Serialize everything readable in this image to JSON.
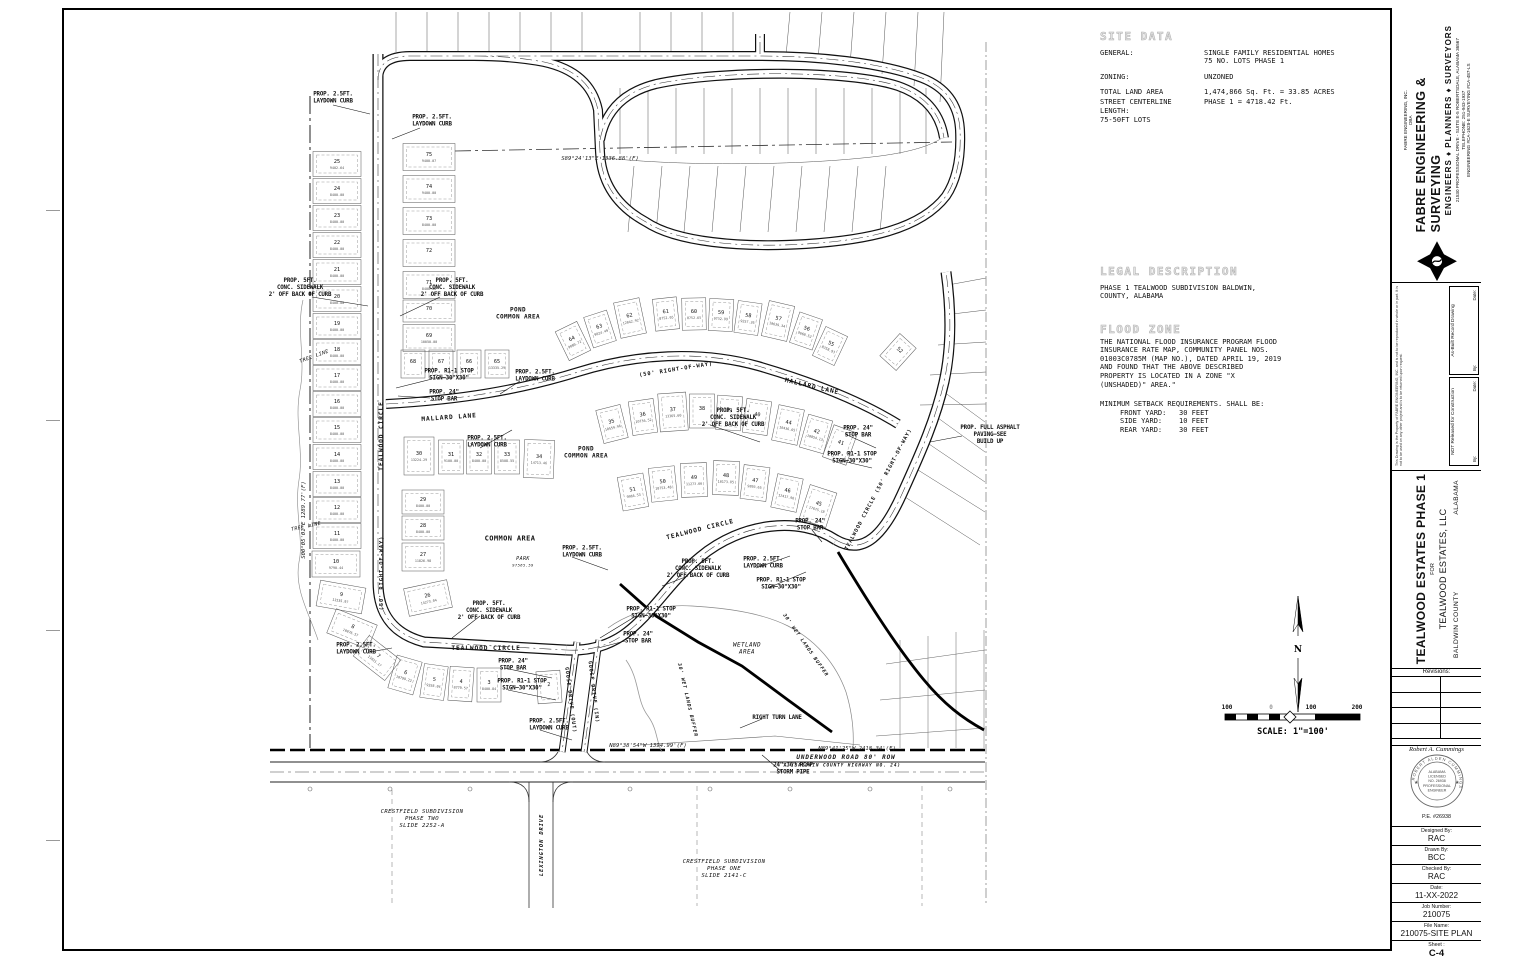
{
  "titleblock": {
    "firm": {
      "company_small": "FABRE ENGINEERING, INC.",
      "dba": "DBA",
      "name": "FABRE ENGINEERING & SURVEYING",
      "tagline": "ENGINEERS ♦ PLANNERS ♦ SURVEYORS",
      "address": "21530 PROFESSIONAL DRIVE - SUITE E-5   ROBERTSDALE, ALABAMA 36567",
      "phone": "TELEPHONE: 251-943-1937",
      "licenses": "ENGINEERING #CA-1628-E      SURVEYING #CA-487-LS"
    },
    "release": {
      "disclaimer": "This Drawing is the Property of FABRE ENGINEERING, INC. and is not to be reproduced in whole or in part. It is not to be used on any other project and is to be returned upon request.",
      "not_released": "NOT Released for Construction",
      "as_built": "As-Built Record Drawing",
      "by": "By:",
      "date": "Date:"
    },
    "project": {
      "title": "TEALWOOD ESTATES PHASE 1",
      "for_label": "FOR",
      "client": "TEALWOOD ESTATES, LLC",
      "county": "BALDWIN COUNTY",
      "state": "ALABAMA"
    },
    "revisions_label": "Revisions:",
    "seal": {
      "engineer": "Robert A. Cummings",
      "pe": "P.E. #26938",
      "ring_name": "ROBERT ALDEN CUMMINGS",
      "lines": [
        "ALABAMA",
        "LICENSED",
        "NO. 26938",
        "PROFESSIONAL",
        "ENGINEER"
      ]
    },
    "fields": [
      {
        "label": "Designed By:",
        "value": "RAC"
      },
      {
        "label": "Drawn By:",
        "value": "BCC"
      },
      {
        "label": "Checked By:",
        "value": "RAC"
      },
      {
        "label": "Date:",
        "value": "11-XX-2022"
      },
      {
        "label": "Job Number:",
        "value": "210075"
      },
      {
        "label": "File Name:",
        "value": "210075-SITE PLAN"
      },
      {
        "label": "Sheet :",
        "value": "C-4"
      }
    ]
  },
  "notes": {
    "site_data": {
      "title": "SITE DATA",
      "rows": [
        {
          "l": "GENERAL:",
          "v": "SINGLE FAMILY RESIDENTIAL HOMES\n75 NO. LOTS PHASE 1"
        },
        {
          "l": "ZONING:",
          "v": "UNZONED"
        },
        {
          "l": "TOTAL LAND AREA",
          "v": "1,474,866 Sq. Ft. =  33.85 ACRES"
        },
        {
          "l": "STREET CENTERLINE LENGTH:",
          "v": "PHASE 1 = 4718.42 Ft."
        },
        {
          "l": "75-50FT LOTS",
          "v": ""
        }
      ]
    },
    "legal": {
      "title": "LEGAL DESCRIPTION",
      "body": "PHASE 1 TEALWOOD SUBDIVISION BALDWIN,\nCOUNTY, ALABAMA"
    },
    "flood": {
      "title": "FLOOD ZONE",
      "body": "THE NATIONAL FLOOD INSURANCE PROGRAM FLOOD\nINSURANCE RATE MAP, COMMUNITY PANEL NOS.\n01003C0785M (MAP NO.), DATED APRIL 19, 2019\nAND FOUND THAT THE ABOVE DESCRIBED\nPROPERTY IS LOCATED IN A ZONE \"X\n(UNSHADED)\" AREA.\""
    },
    "setbacks": {
      "heading": "MINIMUM SETBACK REQUIREMENTS. SHALL BE:",
      "rows": "FRONT YARD:   30 FEET\nSIDE YARD:    10 FEET\nREAR YARD:    30 FEET"
    }
  },
  "plan": {
    "north_label": "N",
    "scalebar": {
      "labels": [
        "100",
        "0",
        "100",
        "200"
      ],
      "text": "SCALE: 1\"=100'"
    },
    "streets": [
      {
        "t": "TEALWOOD CIRCLE",
        "x": 381,
        "y": 436,
        "r": -90
      },
      {
        "t": "(50' RIGHT-OF-WAY)",
        "x": 381,
        "y": 573,
        "r": -90,
        "s": 5.4
      },
      {
        "t": "MALLARD LANE",
        "x": 449,
        "y": 417,
        "r": -4
      },
      {
        "t": "(50' RIGHT-OF-WAY)",
        "x": 676,
        "y": 369,
        "r": -9,
        "s": 5.4
      },
      {
        "t": "MALLARD LANE",
        "x": 812,
        "y": 386,
        "r": 13
      },
      {
        "t": "TEALWOOD CIRCLE",
        "x": 486,
        "y": 648,
        "r": 0
      },
      {
        "t": "TEALWOOD CIRCLE",
        "x": 700,
        "y": 529,
        "r": -14
      },
      {
        "t": "TEALWOOD CIRCLE (50' RIGHT-OF-WAY)",
        "x": 878,
        "y": 489,
        "r": -62,
        "s": 5.2
      },
      {
        "t": "GOOSE DRIVE (OUT)",
        "x": 571,
        "y": 700,
        "r": 83,
        "s": 5
      },
      {
        "t": "GOOSE DRIVE (IN)",
        "x": 594,
        "y": 692,
        "r": 83,
        "s": 5
      },
      {
        "t": "LEXINGTON DRIVE",
        "x": 541,
        "y": 845,
        "r": -90,
        "s": 5.4,
        "i": 1
      },
      {
        "t": "UNDERWOOD ROAD 80' ROW",
        "x": 846,
        "y": 757,
        "i": 1,
        "s": 6
      },
      {
        "t": "(BALDWIN COUNTY HIGHWAY NO. 24)",
        "x": 846,
        "y": 765,
        "i": 1,
        "s": 4.4
      },
      {
        "t": "30' WET LANDS BUFFER",
        "x": 688,
        "y": 700,
        "r": 77,
        "s": 4.8,
        "i": 1
      },
      {
        "t": "30' WET LANDS BUFFER",
        "x": 806,
        "y": 645,
        "r": 55,
        "s": 4.8,
        "i": 1
      }
    ],
    "callouts": [
      {
        "t": "PROP. 2.5FT.\nLAYDOWN CURB",
        "x": 333,
        "y": 97
      },
      {
        "t": "PROP. 2.5FT.\nLAYDOWN CURB",
        "x": 432,
        "y": 120
      },
      {
        "t": "PROP. 5FT.\nCONC. SIDEWALK\n2' OFF BACK OF CURB",
        "x": 300,
        "y": 287
      },
      {
        "t": "PROP. 5FT.\nCONC. SIDEWALK\n2' OFF BACK OF CURB",
        "x": 452,
        "y": 287
      },
      {
        "t": "PROP. R1-1 STOP\nSIGN—30\"X30\"",
        "x": 449,
        "y": 374
      },
      {
        "t": "PROP. 24\"\nSTOP BAR",
        "x": 444,
        "y": 395
      },
      {
        "t": "PROP. 2.5FT.\nLAYDOWN CURB",
        "x": 535,
        "y": 375
      },
      {
        "t": "PROP. 2.5FT.\nLAYDOWN CURB",
        "x": 487,
        "y": 441
      },
      {
        "t": "PROP. 5FT.\nCONC. SIDEWALK\n2' OFF BACK OF CURB",
        "x": 733,
        "y": 417
      },
      {
        "t": "PROP. 24\"\nSTOP BAR",
        "x": 858,
        "y": 431
      },
      {
        "t": "PROP. R1-1 STOP\nSIGN—30\"X30\"",
        "x": 852,
        "y": 457
      },
      {
        "t": "PROP. FULL ASPHALT\nPAVING—SEE\nBUILD UP",
        "x": 990,
        "y": 434
      },
      {
        "t": "PROP. 2.5FT.\nLAYDOWN CURB",
        "x": 582,
        "y": 551
      },
      {
        "t": "PROP. 5FT.\nCONC. SIDEWALK\n2' OFF BACK OF CURB",
        "x": 698,
        "y": 568
      },
      {
        "t": "PROP. 2.5FT.\nLAYDOWN CURB",
        "x": 763,
        "y": 562
      },
      {
        "t": "PROP. R1-1 STOP\nSIGN—30\"X30\"",
        "x": 781,
        "y": 583
      },
      {
        "t": "PROP. 24\"\nSTOP BAR",
        "x": 810,
        "y": 524
      },
      {
        "t": "PROP. R1-1 STOP\nSIGN—30\"X30\"",
        "x": 651,
        "y": 612
      },
      {
        "t": "PROP. 24\"\nSTOP BAR",
        "x": 638,
        "y": 637
      },
      {
        "t": "PROP. 2.5FT.\nLAYDOWN CURB",
        "x": 356,
        "y": 648
      },
      {
        "t": "PROP. 5FT.\nCONC. SIDEWALK\n2' OFF BACK OF CURB",
        "x": 489,
        "y": 610
      },
      {
        "t": "PROP. R1-1 STOP\nSIGN—30\"X30\"",
        "x": 522,
        "y": 684
      },
      {
        "t": "PROP. 24\"\nSTOP BAR",
        "x": 513,
        "y": 664
      },
      {
        "t": "PROP. 2.5FT.\nLAYDOWN CURB",
        "x": 549,
        "y": 724
      },
      {
        "t": "RIGHT TURN LANE",
        "x": 777,
        "y": 717
      },
      {
        "t": "24\"x36\" RCAP\nSTORM PIPE",
        "x": 793,
        "y": 768
      }
    ],
    "areas": [
      {
        "t": "POND\nCOMMON AREA",
        "x": 518,
        "y": 313
      },
      {
        "t": "POND\nCOMMON AREA",
        "x": 586,
        "y": 452
      },
      {
        "t": "COMMON AREA",
        "x": 510,
        "y": 538,
        "s": 7
      },
      {
        "t": "PARK",
        "x": 523,
        "y": 558,
        "s": 5,
        "i": 1
      },
      {
        "t": "97565.59",
        "x": 523,
        "y": 565,
        "s": 3.8,
        "i": 1
      },
      {
        "t": "WETLAND\nAREA",
        "x": 747,
        "y": 648,
        "i": 1,
        "s": 6
      },
      {
        "t": "CRESTFIELD SUBDIVISION\nPHASE TWO\nSLIDE 2252-A",
        "x": 422,
        "y": 818,
        "i": 1,
        "s": 5.6
      },
      {
        "t": "CRESTFIELD SUBDIVISION\nPHASE ONE\nSLIDE 2141-C",
        "x": 724,
        "y": 868,
        "i": 1,
        "s": 5.6
      },
      {
        "t": "TREE LINE",
        "x": 314,
        "y": 356,
        "i": 1,
        "r": -20,
        "s": 5
      },
      {
        "t": "TREE LINE",
        "x": 306,
        "y": 526,
        "i": 1,
        "r": -12,
        "s": 5
      }
    ],
    "bearings": [
      {
        "t": "S89°24'13\"E 1336.88'(F)",
        "x": 600,
        "y": 158
      },
      {
        "t": "S00°05'01\"E 1289.77'(F)",
        "x": 303,
        "y": 520,
        "r": -90
      },
      {
        "t": "N89°38'54\"W 1394.99'(F)",
        "x": 648,
        "y": 745
      },
      {
        "t": "N89°41'25\"W 2418.34'(F)",
        "x": 857,
        "y": 748
      }
    ],
    "lots": [
      {
        "n": "25",
        "a": "9402.64",
        "x": 337,
        "y": 164,
        "w": 48,
        "h": 25
      },
      {
        "n": "24",
        "a": "8400.00",
        "x": 337,
        "y": 191,
        "w": 48,
        "h": 25
      },
      {
        "n": "23",
        "a": "8400.00",
        "x": 337,
        "y": 218,
        "w": 48,
        "h": 25
      },
      {
        "n": "22",
        "a": "8400.00",
        "x": 337,
        "y": 245,
        "w": 48,
        "h": 25
      },
      {
        "n": "21",
        "a": "8400.00",
        "x": 337,
        "y": 272,
        "w": 48,
        "h": 25
      },
      {
        "n": "20",
        "a": "8400.00",
        "x": 337,
        "y": 299,
        "w": 48,
        "h": 25
      },
      {
        "n": "19",
        "a": "8400.00",
        "x": 337,
        "y": 326,
        "w": 48,
        "h": 25
      },
      {
        "n": "18",
        "a": "8400.00",
        "x": 337,
        "y": 352,
        "w": 48,
        "h": 25
      },
      {
        "n": "17",
        "a": "8400.00",
        "x": 337,
        "y": 378,
        "w": 48,
        "h": 25
      },
      {
        "n": "16",
        "a": "8400.00",
        "x": 337,
        "y": 404,
        "w": 48,
        "h": 25
      },
      {
        "n": "15",
        "a": "8400.00",
        "x": 337,
        "y": 430,
        "w": 48,
        "h": 25
      },
      {
        "n": "14",
        "a": "8400.00",
        "x": 337,
        "y": 457,
        "w": 48,
        "h": 25
      },
      {
        "n": "13",
        "a": "8400.00",
        "x": 337,
        "y": 484,
        "w": 48,
        "h": 25
      },
      {
        "n": "12",
        "a": "8400.00",
        "x": 337,
        "y": 510,
        "w": 48,
        "h": 25
      },
      {
        "n": "11",
        "a": "8400.00",
        "x": 337,
        "y": 536,
        "w": 48,
        "h": 25
      },
      {
        "n": "10",
        "a": "9790.44",
        "x": 336,
        "y": 564,
        "w": 48,
        "h": 26
      },
      {
        "n": "9",
        "a": "11535.97",
        "x": 341,
        "y": 597,
        "r": 10,
        "w": 46,
        "h": 26
      },
      {
        "n": "8",
        "a": "10076.57",
        "x": 352,
        "y": 629,
        "r": 22,
        "w": 44,
        "h": 26
      },
      {
        "n": "7",
        "a": "11021.17",
        "x": 377,
        "y": 658,
        "r": 38,
        "w": 40,
        "h": 26
      },
      {
        "n": "6",
        "a": "10799.22",
        "x": 405,
        "y": 675,
        "r": 16,
        "w": 26,
        "h": 34
      },
      {
        "n": "5",
        "a": "9358.84",
        "x": 434,
        "y": 682,
        "r": 8,
        "w": 24,
        "h": 34
      },
      {
        "n": "4",
        "a": "8779.57",
        "x": 461,
        "y": 684,
        "r": 4,
        "w": 24,
        "h": 34
      },
      {
        "n": "3",
        "a": "8400.84",
        "x": 489,
        "y": 685,
        "w": 24,
        "h": 34
      },
      {
        "n": "2",
        "x": 549,
        "y": 687,
        "r": -4,
        "w": 24,
        "h": 32
      },
      {
        "n": "75",
        "a": "9400.07",
        "x": 429,
        "y": 157,
        "w": 52,
        "h": 27
      },
      {
        "n": "74",
        "a": "9400.00",
        "x": 429,
        "y": 189,
        "w": 52,
        "h": 27
      },
      {
        "n": "73",
        "a": "8400.00",
        "x": 429,
        "y": 221,
        "w": 52,
        "h": 27
      },
      {
        "n": "72",
        "x": 429,
        "y": 253,
        "w": 52,
        "h": 27
      },
      {
        "n": "71",
        "a": "8400.00",
        "x": 429,
        "y": 285,
        "w": 52,
        "h": 27
      },
      {
        "n": "70",
        "x": 429,
        "y": 311,
        "w": 52,
        "h": 22
      },
      {
        "n": "69",
        "a": "10050.00",
        "x": 429,
        "y": 338,
        "w": 52,
        "h": 27
      },
      {
        "n": "68",
        "x": 413,
        "y": 364,
        "w": 24,
        "h": 28
      },
      {
        "n": "67",
        "x": 441,
        "y": 364,
        "w": 24,
        "h": 28
      },
      {
        "n": "66",
        "x": 469,
        "y": 364,
        "w": 24,
        "h": 28
      },
      {
        "n": "65",
        "a": "13335.29",
        "x": 497,
        "y": 364,
        "w": 24,
        "h": 28
      },
      {
        "n": "64",
        "a": "9080.72",
        "x": 573,
        "y": 341,
        "r": -26,
        "w": 24,
        "h": 32
      },
      {
        "n": "63",
        "a": "9024.49",
        "x": 600,
        "y": 329,
        "r": -18,
        "w": 24,
        "h": 32
      },
      {
        "n": "62",
        "a": "12042.92",
        "x": 630,
        "y": 318,
        "r": -12,
        "w": 26,
        "h": 36
      },
      {
        "n": "61",
        "a": "8752.65",
        "x": 666,
        "y": 314,
        "r": -6,
        "w": 24,
        "h": 32
      },
      {
        "n": "60",
        "a": "8752.65",
        "x": 694,
        "y": 314,
        "r": -1,
        "w": 24,
        "h": 32
      },
      {
        "n": "59",
        "a": "9732.99",
        "x": 721,
        "y": 315,
        "r": 3,
        "w": 24,
        "h": 32
      },
      {
        "n": "58",
        "a": "9257.26",
        "x": 748,
        "y": 318,
        "r": 8,
        "w": 24,
        "h": 32
      },
      {
        "n": "57",
        "a": "10639.34",
        "x": 778,
        "y": 321,
        "r": 13,
        "w": 26,
        "h": 36
      },
      {
        "n": "56",
        "a": "9668.52",
        "x": 806,
        "y": 331,
        "r": 19,
        "w": 24,
        "h": 32
      },
      {
        "n": "55",
        "a": "8358.93",
        "x": 830,
        "y": 346,
        "r": 25,
        "w": 24,
        "h": 32
      },
      {
        "n": "52",
        "x": 898,
        "y": 352,
        "r": 42,
        "w": 22,
        "h": 30
      },
      {
        "n": "30",
        "a": "13224.29",
        "x": 419,
        "y": 456,
        "w": 30,
        "h": 38
      },
      {
        "n": "31",
        "a": "9100.00",
        "x": 451,
        "y": 457,
        "w": 25,
        "h": 34
      },
      {
        "n": "32",
        "a": "8400.00",
        "x": 479,
        "y": 457,
        "w": 25,
        "h": 34
      },
      {
        "n": "33",
        "a": "8508.55",
        "x": 507,
        "y": 457,
        "w": 25,
        "h": 34
      },
      {
        "n": "34",
        "a": "14713.46",
        "x": 539,
        "y": 459,
        "r": 2,
        "w": 30,
        "h": 38
      },
      {
        "n": "35",
        "a": "10559.96",
        "x": 612,
        "y": 424,
        "r": -14,
        "w": 25,
        "h": 34
      },
      {
        "n": "36",
        "a": "10736.52",
        "x": 643,
        "y": 417,
        "r": -8,
        "w": 25,
        "h": 34
      },
      {
        "n": "37",
        "a": "13365.60",
        "x": 673,
        "y": 412,
        "r": -4,
        "w": 28,
        "h": 38
      },
      {
        "n": "38",
        "x": 702,
        "y": 411,
        "w": 25,
        "h": 34
      },
      {
        "n": "39",
        "x": 729,
        "y": 413,
        "r": 4,
        "w": 25,
        "h": 34
      },
      {
        "n": "40",
        "x": 757,
        "y": 417,
        "r": 8,
        "w": 25,
        "h": 34
      },
      {
        "n": "44",
        "a": "10436.65",
        "x": 788,
        "y": 425,
        "r": 12,
        "w": 26,
        "h": 36
      },
      {
        "n": "42",
        "a": "10854.13",
        "x": 816,
        "y": 434,
        "r": 16,
        "w": 25,
        "h": 34
      },
      {
        "n": "41",
        "x": 840,
        "y": 445,
        "r": 20,
        "w": 25,
        "h": 34
      },
      {
        "n": "51",
        "a": "9966.53",
        "x": 633,
        "y": 492,
        "r": -10,
        "w": 26,
        "h": 34
      },
      {
        "n": "50",
        "a": "10753.48",
        "x": 663,
        "y": 484,
        "r": -6,
        "w": 26,
        "h": 34
      },
      {
        "n": "49",
        "a": "11273.66",
        "x": 694,
        "y": 480,
        "r": -2,
        "w": 26,
        "h": 34
      },
      {
        "n": "48",
        "a": "10173.85",
        "x": 726,
        "y": 478,
        "r": 2,
        "w": 26,
        "h": 34
      },
      {
        "n": "47",
        "a": "9893.65",
        "x": 755,
        "y": 483,
        "r": 7,
        "w": 26,
        "h": 34
      },
      {
        "n": "46",
        "a": "12417.96",
        "x": 787,
        "y": 493,
        "r": 12,
        "w": 26,
        "h": 34
      },
      {
        "n": "45",
        "a": "17675.18",
        "x": 818,
        "y": 506,
        "r": 18,
        "w": 28,
        "h": 36
      },
      {
        "n": "29",
        "a": "8400.00",
        "x": 423,
        "y": 502,
        "w": 42,
        "h": 24
      },
      {
        "n": "28",
        "a": "8400.00",
        "x": 423,
        "y": 528,
        "w": 42,
        "h": 24
      },
      {
        "n": "27",
        "a": "11826.98",
        "x": 423,
        "y": 557,
        "w": 42,
        "h": 28
      },
      {
        "n": "26",
        "a": "14273.04",
        "x": 428,
        "y": 598,
        "r": -12,
        "w": 44,
        "h": 28
      }
    ]
  }
}
